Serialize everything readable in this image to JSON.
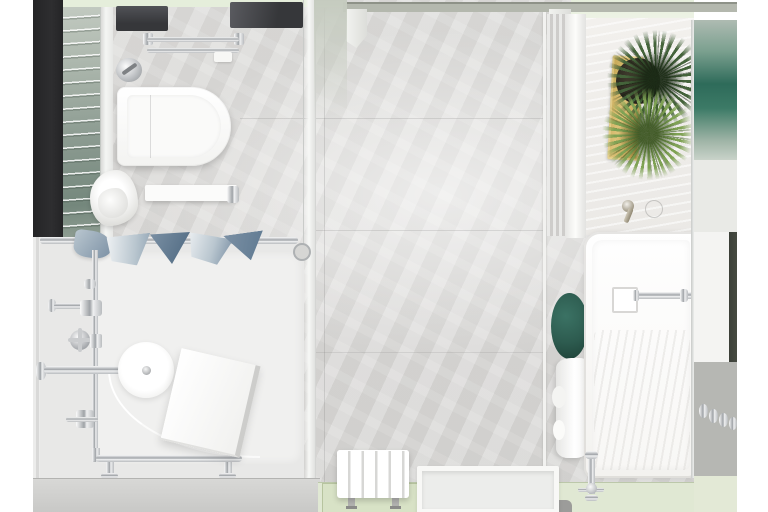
{
  "meta": {
    "content_type": "photorealistic 3d render",
    "subject": "modern bathroom viewed top-down (bird's eye plan view)",
    "canvas": {
      "width": 768,
      "height": 512
    },
    "margins": "white bands on left and right edges"
  },
  "palette": {
    "wall_dark": "#2e2e30",
    "floor_marble": "#dad9d7",
    "shower_base": "#e8e8e7",
    "tray_white": "#f0f0ef",
    "counter_marble": "#f2f0ed",
    "sage_tile": "#8d9c92",
    "sage_tile_light": "#c8cfc6",
    "glass_teal": "#2e6b5a",
    "pale_green": "#e5eedb",
    "threshold_gray": "#b4b8ae",
    "chrome_mid": "#9ea2a6",
    "gold_mid": "#c4a654",
    "gold_light": "#ddc278",
    "plant_dark": "#44633a",
    "plant_light": "#7fa254",
    "towel_blue": "#7b90a4",
    "towel_blue_light": "#b9c6cf",
    "towel_blue_dark": "#4d6880",
    "stool_teal": "#2d5b4f",
    "bottom_glass": "#e0e8d3",
    "planks_gray": "#b6b7b3",
    "dark_edge": "#474b42",
    "gray_bar": "#9c9c9a"
  },
  "scene": {
    "objects": [
      {
        "name": "marble-floor",
        "desc": "large light-grey veined marble tiles with grout lines"
      },
      {
        "name": "dark-wall-strip",
        "desc": "charcoal wall section, upper left edge"
      },
      {
        "name": "sage-glass-tile-wall",
        "desc": "green-grey glass tile strip, left wall"
      },
      {
        "name": "ceiling-rain-shower-panels",
        "desc": "two dark recessed ceiling panels, top"
      },
      {
        "name": "double-towel-rail",
        "desc": "chrome double bar above toilet"
      },
      {
        "name": "flush-valve",
        "desc": "round chrome valve with lever"
      },
      {
        "name": "toilet",
        "desc": "white wall-hung toilet seen from above"
      },
      {
        "name": "shelf-with-towel",
        "desc": "white shelf and crumpled hand towel"
      },
      {
        "name": "doorway-threshold",
        "desc": "grey top rail with two white door jambs"
      },
      {
        "name": "shower-enclosure",
        "desc": "glass shower with chrome frame, lower left"
      },
      {
        "name": "draped-towels",
        "desc": "blue patterned towels over shower rail"
      },
      {
        "name": "shower-head",
        "desc": "round white overhead shower on chrome arm"
      },
      {
        "name": "exposed-shower-valves",
        "desc": "chrome thermostatic pipework and cross handles"
      },
      {
        "name": "shower-seat",
        "desc": "tilted white square seat/panel"
      },
      {
        "name": "gold-tray-with-plants",
        "desc": "brass tray, planter and two green palm fronds"
      },
      {
        "name": "teal-glass-mosaic",
        "desc": "teal glass tile strip, upper right wall"
      },
      {
        "name": "bathtub",
        "desc": "white rectangular tub along right wall with square drain and chrome bar"
      },
      {
        "name": "deck-faucet",
        "desc": "wall-mounted mixer on marble deck"
      },
      {
        "name": "teal-stool",
        "desc": "small round deep-green stool beside tub"
      },
      {
        "name": "bath-towel",
        "desc": "white towel draped beside tub"
      },
      {
        "name": "tub-filler-faucet",
        "desc": "chrome freestanding filler at tub foot"
      },
      {
        "name": "plank-wall-with-hooks",
        "desc": "grey plank tiles with chrome hooks, lower right"
      },
      {
        "name": "slatted-stool",
        "desc": "white slatted shower stool on green glass mat"
      },
      {
        "name": "bath-tray",
        "desc": "white rimmed tray at bottom edge"
      },
      {
        "name": "green-glass-floor-strip",
        "desc": "pale sage glass band along bottom edge"
      }
    ]
  }
}
